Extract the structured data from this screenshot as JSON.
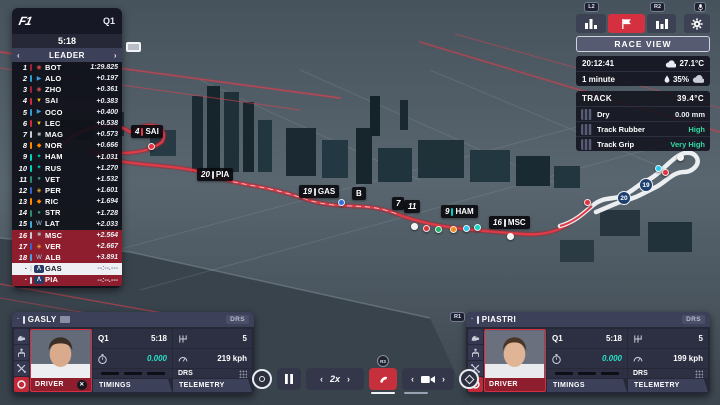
{
  "session": {
    "stage": "Q1",
    "timer": "5:18",
    "leader_label": "LEADER"
  },
  "teams": {
    "alfa": {
      "bar": "#a42134",
      "icon": "◉",
      "icon_color": "#c94a4a"
    },
    "alpine": {
      "bar": "#2f9bd6",
      "icon": "▶",
      "icon_color": "#3aa0e0"
    },
    "ferrari": {
      "bar": "#d7263d",
      "icon": "▼",
      "icon_color": "#f2c014"
    },
    "haas": {
      "bar": "#c8ccd4",
      "icon": "■",
      "icon_color": "#aeb4bf"
    },
    "mclaren": {
      "bar": "#ff8700",
      "icon": "◆",
      "icon_color": "#ff8700"
    },
    "mercedes": {
      "bar": "#00d2be",
      "icon": "✦",
      "icon_color": "#00d2be"
    },
    "aston": {
      "bar": "#2f8a6e",
      "icon": "●",
      "icon_color": "#2f9a78"
    },
    "redbull": {
      "bar": "#3b62c8",
      "icon": "◈",
      "icon_color": "#e0a32e"
    },
    "williams": {
      "bar": "#3fa9e0",
      "icon": "W",
      "icon_color": "#9fd4f2"
    },
    "alphatauri": {
      "bar": "#d8dce5",
      "icon": "Λ",
      "icon_color": "#ffffff",
      "badge_bg": "#273a63"
    }
  },
  "leaderboard": {
    "rows": [
      {
        "pos": "1",
        "code": "BOT",
        "time": "1:29.825",
        "team": "alfa"
      },
      {
        "pos": "2",
        "code": "ALO",
        "time": "+0.197",
        "team": "alpine"
      },
      {
        "pos": "3",
        "code": "ZHO",
        "time": "+0.361",
        "team": "alfa"
      },
      {
        "pos": "4",
        "code": "SAI",
        "time": "+0.383",
        "team": "ferrari"
      },
      {
        "pos": "5",
        "code": "OCO",
        "time": "+0.400",
        "team": "alpine"
      },
      {
        "pos": "6",
        "code": "LEC",
        "time": "+0.538",
        "team": "ferrari"
      },
      {
        "pos": "7",
        "code": "MAG",
        "time": "+0.573",
        "team": "haas"
      },
      {
        "pos": "8",
        "code": "NOR",
        "time": "+0.666",
        "team": "mclaren"
      },
      {
        "pos": "9",
        "code": "HAM",
        "time": "+1.031",
        "team": "mercedes"
      },
      {
        "pos": "10",
        "code": "RUS",
        "time": "+1.270",
        "team": "mercedes"
      },
      {
        "pos": "11",
        "code": "VET",
        "time": "+1.532",
        "team": "aston"
      },
      {
        "pos": "12",
        "code": "PER",
        "time": "+1.601",
        "team": "redbull"
      },
      {
        "pos": "13",
        "code": "RIC",
        "time": "+1.694",
        "team": "mclaren"
      },
      {
        "pos": "14",
        "code": "STR",
        "time": "+1.728",
        "team": "aston"
      },
      {
        "pos": "15",
        "code": "LAT",
        "time": "+2.033",
        "team": "williams"
      },
      {
        "pos": "16",
        "code": "MSC",
        "time": "+2.564",
        "team": "haas",
        "zone": "drop"
      },
      {
        "pos": "17",
        "code": "VER",
        "time": "+2.667",
        "team": "redbull",
        "zone": "drop"
      },
      {
        "pos": "18",
        "code": "ALB",
        "time": "+3.891",
        "team": "williams",
        "zone": "drop"
      },
      {
        "pos": "·",
        "code": "GAS",
        "time": "--:--.---",
        "team": "alphatauri",
        "zone": "selected"
      },
      {
        "pos": "·",
        "code": "PIA",
        "time": "--:--.---",
        "team": "alphatauri",
        "zone": "drop"
      }
    ]
  },
  "hud": {
    "l2": "L2",
    "r2": "R2",
    "race_view": "RACE VIEW"
  },
  "weather": {
    "clock": "20:12:41",
    "air_temp": "27.1°C",
    "change_in": "1 minute",
    "humidity": "35%"
  },
  "track_info": {
    "title": "TRACK",
    "temp": "39.4°C",
    "rows": [
      {
        "icon": "dry-surface-icon",
        "label": "Dry",
        "value": "0.00 mm",
        "good": false
      },
      {
        "icon": "track-rubber-icon",
        "label": "Track Rubber",
        "value": "High",
        "good": true
      },
      {
        "icon": "track-grip-icon",
        "label": "Track Grip",
        "value": "Very High",
        "good": true
      }
    ]
  },
  "map": {
    "labels": [
      {
        "num": "4",
        "code": "SAI",
        "x": 131,
        "y": 125,
        "bar": "#e03a47"
      },
      {
        "num": "20",
        "code": "PIA",
        "x": 197,
        "y": 168,
        "bar": "#d8dce5"
      },
      {
        "num": "19",
        "code": "GAS",
        "x": 299,
        "y": 185,
        "bar": "#d8dce5"
      },
      {
        "num": "",
        "code": "B",
        "x": 352,
        "y": 187,
        "bar": ""
      },
      {
        "num": "7",
        "code": "",
        "x": 392,
        "y": 197,
        "bar": ""
      },
      {
        "num": "11",
        "code": "",
        "x": 404,
        "y": 200,
        "bar": ""
      },
      {
        "num": "9",
        "code": "HAM",
        "x": 441,
        "y": 205,
        "bar": "#00d2be"
      },
      {
        "num": "16",
        "code": "MSC",
        "x": 489,
        "y": 216,
        "bar": "#e6e8ea"
      }
    ],
    "dots": [
      {
        "x": 148,
        "y": 143,
        "c": "#e03340"
      },
      {
        "x": 338,
        "y": 199,
        "c": "#2f6fe0"
      },
      {
        "x": 411,
        "y": 223,
        "c": "#f2f2f2"
      },
      {
        "x": 423,
        "y": 225,
        "c": "#d8313c"
      },
      {
        "x": 435,
        "y": 226,
        "c": "#1fae62"
      },
      {
        "x": 450,
        "y": 226,
        "c": "#f08a1d"
      },
      {
        "x": 463,
        "y": 225,
        "c": "#28c8f0"
      },
      {
        "x": 474,
        "y": 224,
        "c": "#17d8c0"
      },
      {
        "x": 507,
        "y": 233,
        "c": "#f2f2f2"
      },
      {
        "x": 584,
        "y": 199,
        "c": "#e03340"
      },
      {
        "x": 662,
        "y": 169,
        "c": "#e03340"
      },
      {
        "x": 655,
        "y": 165,
        "c": "#28c8f0"
      },
      {
        "x": 677,
        "y": 154,
        "c": "#f2f2f2"
      }
    ],
    "turns": [
      {
        "n": "19",
        "x": 639,
        "y": 178
      },
      {
        "n": "20",
        "x": 617,
        "y": 191
      }
    ]
  },
  "panels": [
    {
      "pos": "·",
      "name": "GASLY",
      "drs": "DRS",
      "session": "Q1",
      "session_time": "5:18",
      "delta": "0.000",
      "gear": "5",
      "speed": "219 kph",
      "drs_label": "DRS",
      "driver": "DRIVER",
      "tab_timings": "TIMINGS",
      "tab_telemetry": "TELEMETRY"
    },
    {
      "pos": "·",
      "name": "PIASTRI",
      "drs": "DRS",
      "session": "Q1",
      "session_time": "5:18",
      "delta": "0.000",
      "gear": "5",
      "speed": "199 kph",
      "drs_label": "DRS",
      "driver": "DRIVER",
      "tab_timings": "TIMINGS",
      "tab_telemetry": "TELEMETRY"
    }
  ],
  "playback": {
    "speed": "2x",
    "radio_badge": "R3",
    "panel_badge": "R1"
  }
}
